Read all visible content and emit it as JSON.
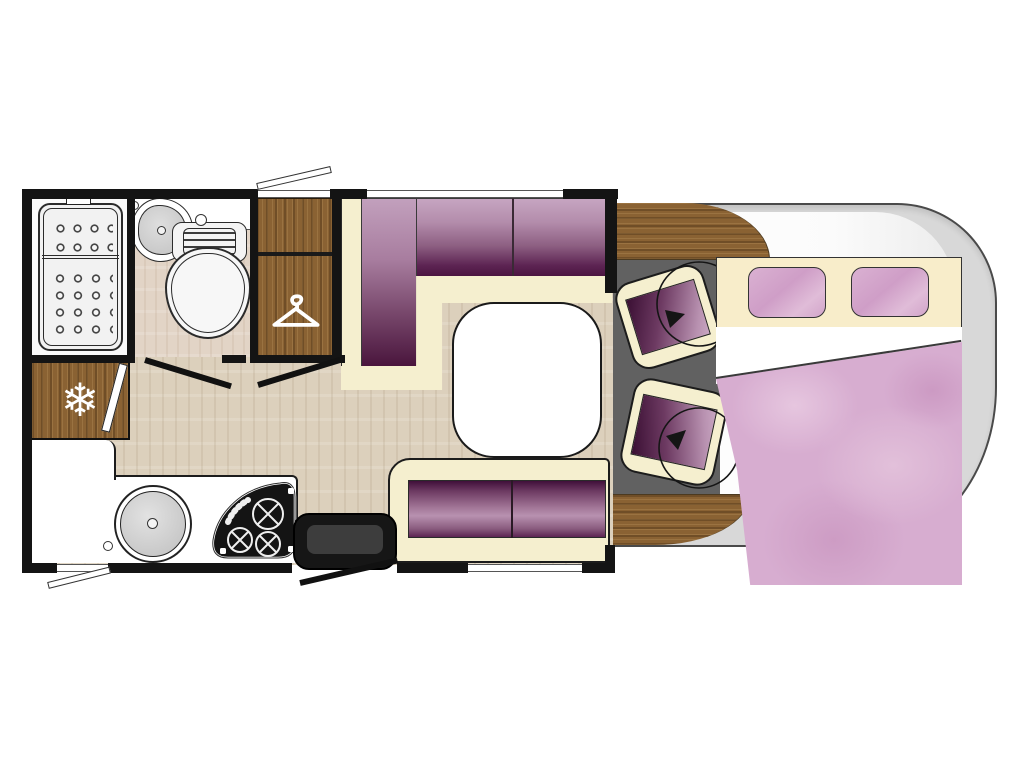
{
  "figure": {
    "kind": "motorhome floor plan, top view",
    "visible_text": "none"
  },
  "icons": {
    "fridge_snowflake": "❄",
    "wardrobe_hanger": "clothes-hanger (drawn as SVG)",
    "swivel_arrow": "rotation arrow (drawn as SVG)"
  },
  "palette": {
    "wall": "#141414",
    "wood": "#8a6233",
    "hall_floor": "#dcd0bc",
    "bath_floor": "#e2d4c6",
    "upholstery_dark": "#451038",
    "upholstery_light": "#c4a2bd",
    "cream_frame": "#f5efcf",
    "bed_pink": "#d7add0",
    "pillow_pink": "#d4a5c9",
    "cab_body_grey": "#d8d8d8",
    "cab_floor_grey": "#616161",
    "hob_black": "#141414",
    "step_black": "#1f1f1f",
    "table_white": "#ffffff"
  }
}
